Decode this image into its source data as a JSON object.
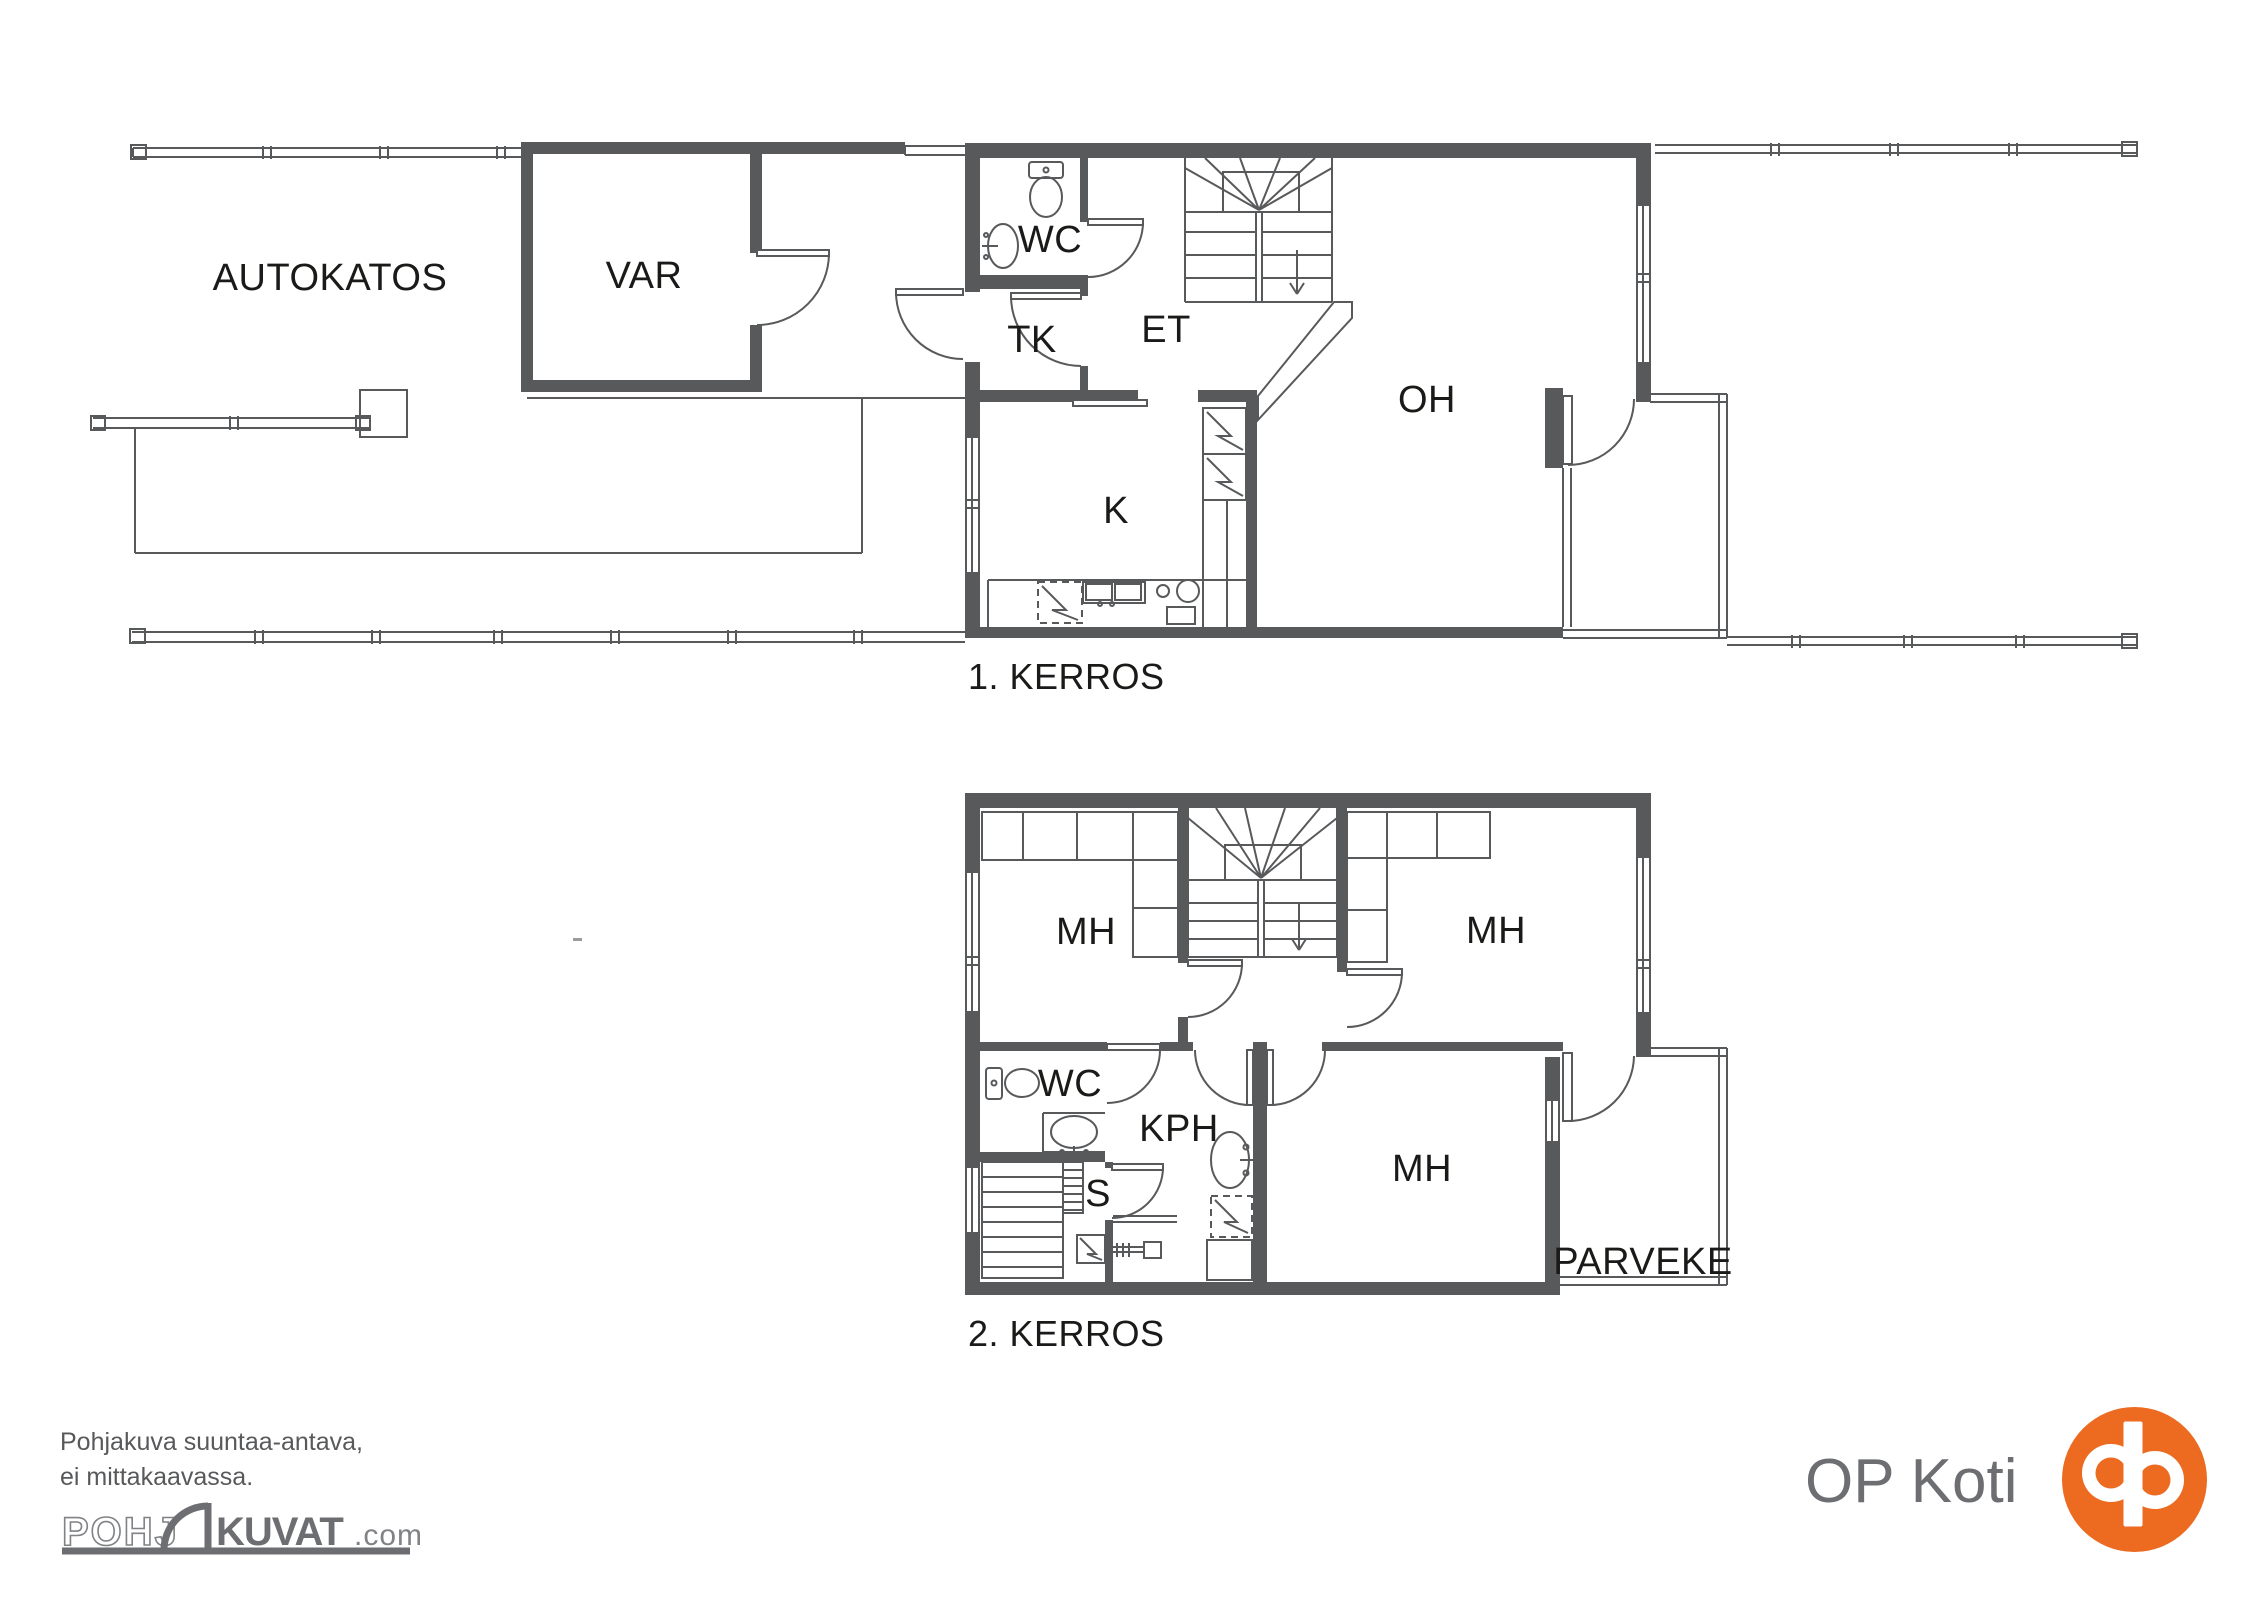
{
  "colors": {
    "wall": "#58595B",
    "line": "#58595B",
    "label": "#1A1A18",
    "gray_dark": "#6D6E71",
    "gray_light": "#808285",
    "op_orange": "#ED6B21"
  },
  "floor1": {
    "caption": "1. KERROS",
    "rooms": {
      "autokatos": "AUTOKATOS",
      "var": "VAR",
      "wc": "WC",
      "tk": "TK",
      "et": "ET",
      "oh": "OH",
      "k": "K"
    }
  },
  "floor2": {
    "caption": "2. KERROS",
    "rooms": {
      "mh_left": "MH",
      "mh_right": "MH",
      "mh_bottom": "MH",
      "wc": "WC",
      "kph": "KPH",
      "s": "S",
      "parveke": "PARVEKE"
    }
  },
  "footer": {
    "disclaimer_line1": "Pohjakuva suuntaa-antava,",
    "disclaimer_line2": "ei mittakaavassa.",
    "logo": {
      "part1": "POHJ",
      "part2": "KUVAT",
      "part3": ".com"
    }
  },
  "brand": {
    "name": "OP Koti"
  }
}
